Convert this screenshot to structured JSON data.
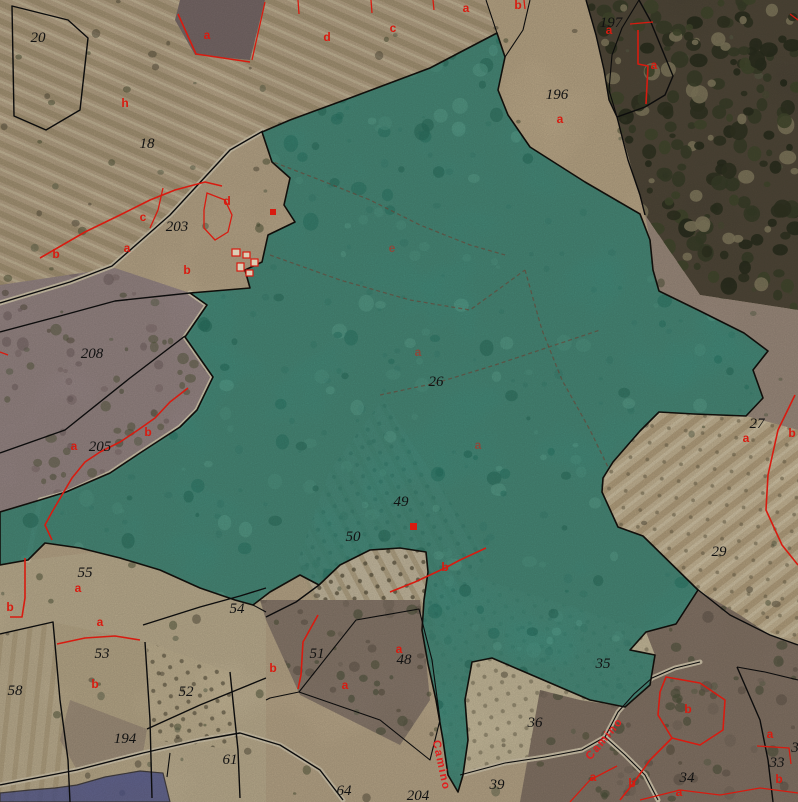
{
  "map": {
    "kind": "cadastral-aerial-view",
    "colors": {
      "selected_parcel_fill": "#2c9082",
      "selected_parcel_border": "#000000",
      "secondary_selection_fill": "#4a55a0",
      "parcel_boundary": "#0c0c0c",
      "subparcel_line": "#d81b10",
      "parcel_number_text": "#121212",
      "subparcel_letter_text": "#d81b10",
      "road_label_text": "#e01f1f",
      "terrain_base": "#c9b697"
    },
    "parcel_numbers": [
      {
        "t": "20",
        "x": 38,
        "y": 42
      },
      {
        "t": "18",
        "x": 147,
        "y": 148
      },
      {
        "t": "203",
        "x": 177,
        "y": 231
      },
      {
        "t": "197",
        "x": 611,
        "y": 27
      },
      {
        "t": "196",
        "x": 557,
        "y": 99
      },
      {
        "t": "208",
        "x": 92,
        "y": 358
      },
      {
        "t": "205",
        "x": 100,
        "y": 451
      },
      {
        "t": "26",
        "x": 436,
        "y": 386
      },
      {
        "t": "27",
        "x": 757,
        "y": 428
      },
      {
        "t": "29",
        "x": 719,
        "y": 556
      },
      {
        "t": "49",
        "x": 401,
        "y": 506
      },
      {
        "t": "50",
        "x": 353,
        "y": 541
      },
      {
        "t": "51",
        "x": 317,
        "y": 658
      },
      {
        "t": "48",
        "x": 404,
        "y": 664
      },
      {
        "t": "52",
        "x": 186,
        "y": 696
      },
      {
        "t": "53",
        "x": 102,
        "y": 658
      },
      {
        "t": "54",
        "x": 237,
        "y": 613
      },
      {
        "t": "55",
        "x": 85,
        "y": 577
      },
      {
        "t": "58",
        "x": 15,
        "y": 695
      },
      {
        "t": "61",
        "x": 230,
        "y": 764
      },
      {
        "t": "64",
        "x": 344,
        "y": 795
      },
      {
        "t": "194",
        "x": 125,
        "y": 743
      },
      {
        "t": "204",
        "x": 418,
        "y": 800
      },
      {
        "t": "34",
        "x": 687,
        "y": 782
      },
      {
        "t": "33",
        "x": 777,
        "y": 767
      },
      {
        "t": "35",
        "x": 603,
        "y": 668
      },
      {
        "t": "36",
        "x": 535,
        "y": 727
      },
      {
        "t": "39",
        "x": 497,
        "y": 789
      },
      {
        "t": "3",
        "x": 795,
        "y": 752
      }
    ],
    "subparcel_letters": [
      {
        "t": "a",
        "x": 207,
        "y": 39
      },
      {
        "t": "h",
        "x": 125,
        "y": 107
      },
      {
        "t": "d",
        "x": 227,
        "y": 205
      },
      {
        "t": "c",
        "x": 143,
        "y": 221
      },
      {
        "t": "a",
        "x": 127,
        "y": 252
      },
      {
        "t": "b",
        "x": 56,
        "y": 258
      },
      {
        "t": "d",
        "x": 327,
        "y": 41
      },
      {
        "t": "c",
        "x": 393,
        "y": 32
      },
      {
        "t": "a",
        "x": 466,
        "y": 12
      },
      {
        "t": "b",
        "x": 518,
        "y": 9
      },
      {
        "t": "e",
        "x": 392,
        "y": 252,
        "f": 1
      },
      {
        "t": "a",
        "x": 560,
        "y": 123
      },
      {
        "t": "a",
        "x": 609,
        "y": 34
      },
      {
        "t": "a",
        "x": 654,
        "y": 69
      },
      {
        "t": "b",
        "x": 187,
        "y": 274
      },
      {
        "t": "a",
        "x": 74,
        "y": 450
      },
      {
        "t": "b",
        "x": 148,
        "y": 436
      },
      {
        "t": "a",
        "x": 418,
        "y": 356,
        "f": 1
      },
      {
        "t": "a",
        "x": 478,
        "y": 449,
        "f": 1
      },
      {
        "t": "a",
        "x": 746,
        "y": 442
      },
      {
        "t": "b",
        "x": 792,
        "y": 437
      },
      {
        "t": "a",
        "x": 78,
        "y": 592
      },
      {
        "t": "b",
        "x": 10,
        "y": 611
      },
      {
        "t": "a",
        "x": 100,
        "y": 626
      },
      {
        "t": "b",
        "x": 95,
        "y": 688
      },
      {
        "t": "b",
        "x": 273,
        "y": 672
      },
      {
        "t": "a",
        "x": 345,
        "y": 689
      },
      {
        "t": "a",
        "x": 399,
        "y": 653
      },
      {
        "t": "b",
        "x": 445,
        "y": 571
      },
      {
        "t": "b",
        "x": 688,
        "y": 713
      },
      {
        "t": "a",
        "x": 770,
        "y": 738
      },
      {
        "t": "b",
        "x": 779,
        "y": 783
      },
      {
        "t": "a",
        "x": 593,
        "y": 781
      },
      {
        "t": "b",
        "x": 632,
        "y": 787
      },
      {
        "t": "a",
        "x": 679,
        "y": 796
      }
    ],
    "road_labels": [
      {
        "t": "Camino",
        "x": 438,
        "y": 766,
        "angle": 78
      },
      {
        "t": "Camino",
        "x": 607,
        "y": 741,
        "angle": -50
      }
    ]
  }
}
